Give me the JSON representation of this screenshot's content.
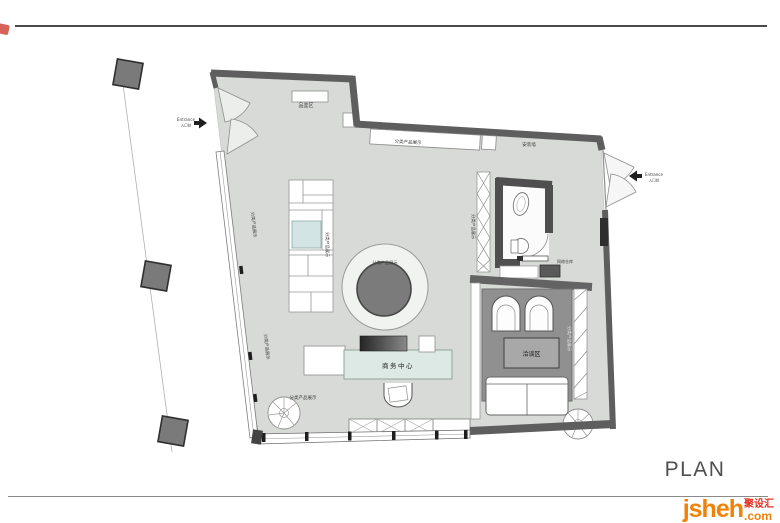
{
  "plan": {
    "title": "PLAN",
    "labels": {
      "entrance_left_en": "Entrance",
      "entrance_left_cn": "入口处",
      "entrance_right_en": "Entrance",
      "entrance_right_cn": "入口处",
      "tasting_area": "品鉴区",
      "display_top": "分类产品展示",
      "install_wall": "安装墙",
      "display_left_upper": "分类产品展示",
      "shelf_display": "分类产品展示",
      "circle_display": "分类产品展示",
      "bath_shelf_display": "分类产品展示",
      "network_storage": "网络仓库",
      "display_left_lower": "分类产品展示",
      "business_center": "商务中心",
      "meeting_area": "洽谈区",
      "meeting_display": "分类产品展示",
      "display_bottom": "分类产品展示"
    },
    "colors": {
      "floor": "#d7dad6",
      "wall": "#5e5e5e",
      "carpet": "#909090",
      "desk": "#dde9e4",
      "circle_inner": "#7b7b7b"
    }
  },
  "footer": {
    "logo_main": "jsheh",
    "logo_suffix": ".com",
    "logo_cn": "聚设汇",
    "brand_orange": "#f0820a",
    "brand_red": "#e03020"
  }
}
